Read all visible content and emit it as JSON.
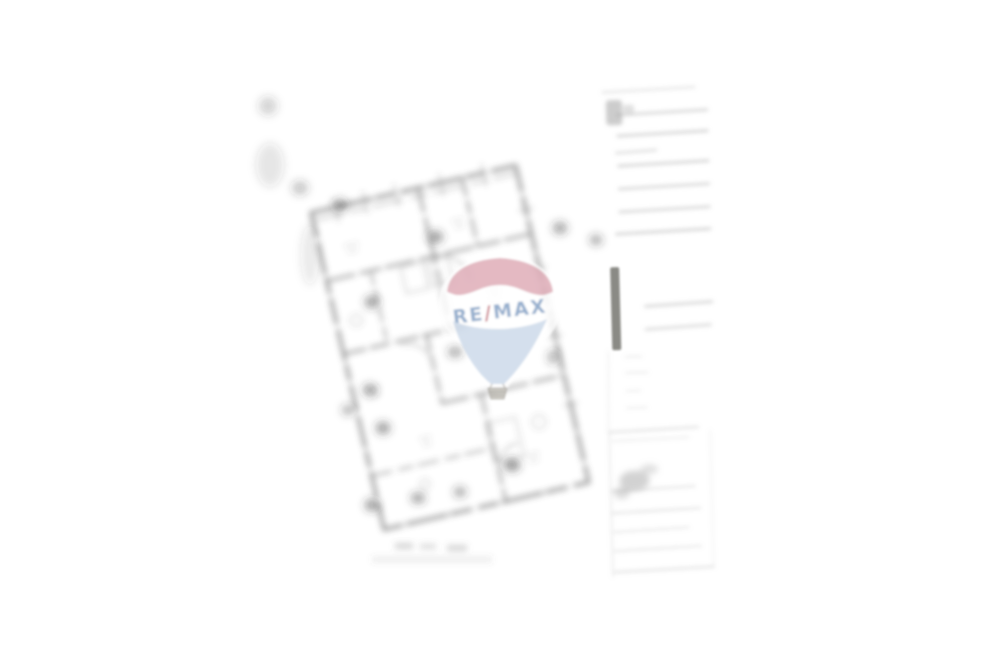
{
  "watermark": {
    "brand": "RE/MAX",
    "re": "RE",
    "slash": "/",
    "max": "MAX",
    "colors": {
      "band_red": "#dca4b0",
      "text_blue": "#84a2c6",
      "slash_red": "#c2606e",
      "cone_blue": "#c9d7e8",
      "basket": "#b5b1a8",
      "halo_white": "#ffffff"
    }
  },
  "canvas": {
    "background": "#ffffff",
    "plan_ink": "#3a3a3a",
    "panel_line_gray": "#a8a8a8",
    "side_bar_gray": "#76766f"
  }
}
